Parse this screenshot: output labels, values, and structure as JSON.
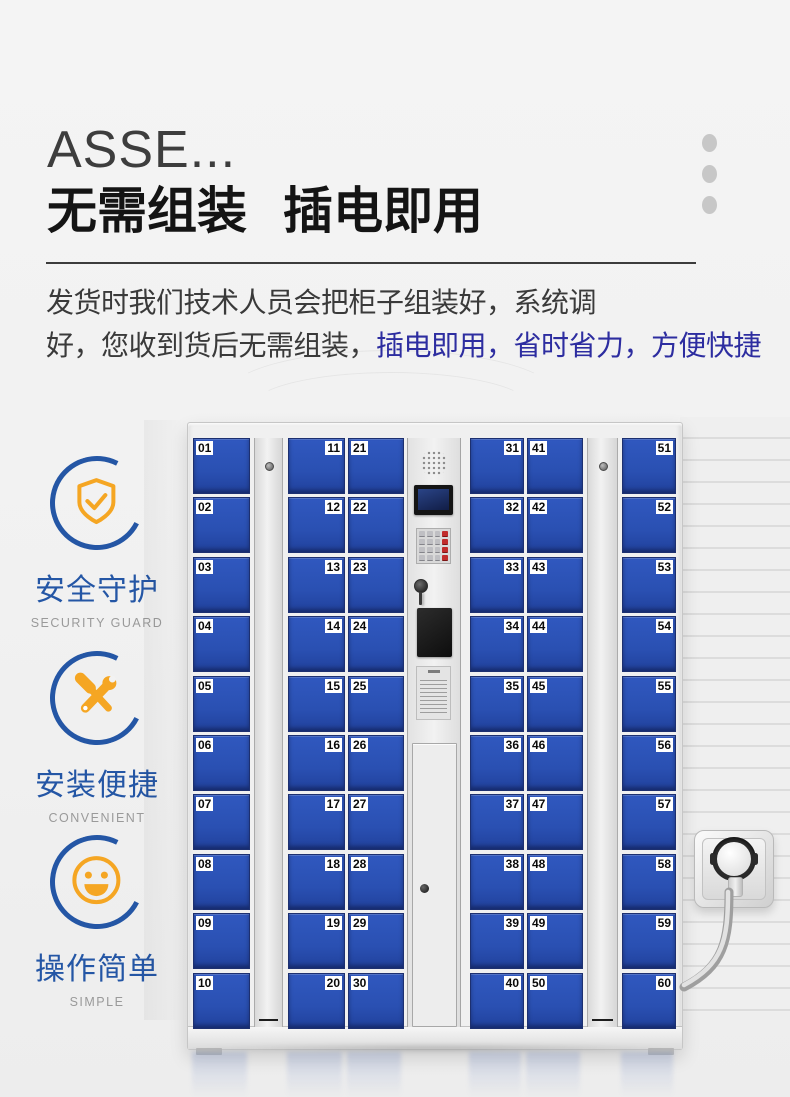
{
  "header": {
    "title_en": "ASSE...",
    "title_cn_part1": "无需组装",
    "title_cn_part2": "插电即用",
    "paragraph_line1": "发货时我们技术人员会把柜子组装好，系统调",
    "paragraph_line2_black": "好，您收到货后无需组装，",
    "paragraph_line2_blue": "插电即用，省时省力，方便快捷",
    "accent_blue": "#2d2da0",
    "decor_dots_count": 3
  },
  "features": [
    {
      "icon": "shield-check-icon",
      "label_cn": "安全守护",
      "label_en": "SECURITY GUARD"
    },
    {
      "icon": "tools-icon",
      "label_cn": "安装便捷",
      "label_en": "CONVENIENT"
    },
    {
      "icon": "smiley-icon",
      "label_cn": "操作简单",
      "label_en": "SIMPLE"
    }
  ],
  "feature_colors": {
    "ring_blue": "#2456a5",
    "icon_orange": "#f5a623",
    "label_blue": "#2456a5",
    "sub_gray": "#9a9a9a"
  },
  "locker": {
    "door_color": "#2a52b4",
    "door_groups": [
      {
        "label_side": "left",
        "numbers": [
          "01",
          "02",
          "03",
          "04",
          "05",
          "06",
          "07",
          "08",
          "09",
          "10"
        ]
      },
      {
        "label_side": "right",
        "numbers": [
          "11",
          "12",
          "13",
          "14",
          "15",
          "16",
          "17",
          "18",
          "19",
          "20"
        ]
      },
      {
        "label_side": "left",
        "numbers": [
          "21",
          "22",
          "23",
          "24",
          "25",
          "26",
          "27",
          "28",
          "29",
          "30"
        ]
      },
      {
        "label_side": "right",
        "numbers": [
          "31",
          "32",
          "33",
          "34",
          "35",
          "36",
          "37",
          "38",
          "39",
          "40"
        ]
      },
      {
        "label_side": "left",
        "numbers": [
          "41",
          "42",
          "43",
          "44",
          "45",
          "46",
          "47",
          "48",
          "49",
          "50"
        ]
      },
      {
        "label_side": "right",
        "numbers": [
          "51",
          "52",
          "53",
          "54",
          "55",
          "56",
          "57",
          "58",
          "59",
          "60"
        ]
      }
    ],
    "control_panel_parts": [
      "speaker",
      "screen",
      "keypad",
      "lock",
      "card-reader",
      "notice-sticker",
      "service-door"
    ]
  },
  "scene": {
    "wall_socket": "eu-socket-with-plug",
    "cable": "power-cable"
  }
}
